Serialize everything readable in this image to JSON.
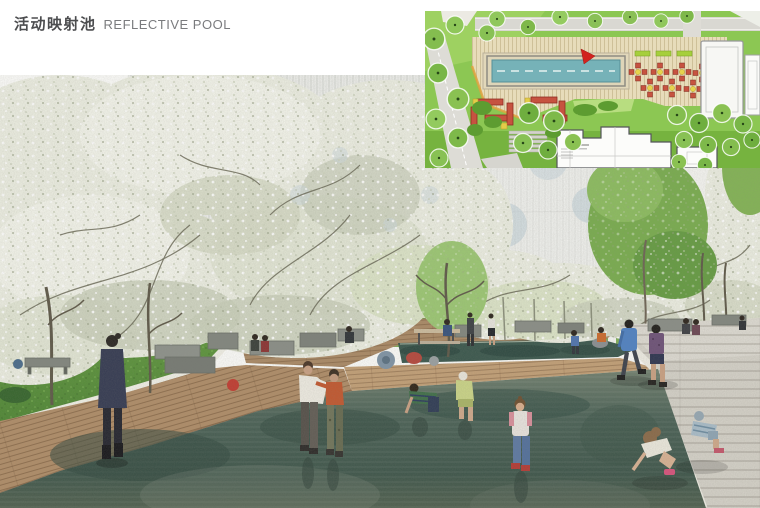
{
  "page": {
    "background": "#ffffff",
    "title_zh": "活动映射池",
    "title_en": "REFLECTIVE POOL"
  },
  "rendering": {
    "label": "reflective-pool-perspective-rendering",
    "scene": "Perspective view of a shallow reflective pool plaza under white blossoming trees; children play in the water, adults rest on stone benches along a timber boardwalk, a stone path runs along the right edge",
    "elements": [
      "white-blossom-canopy",
      "building-facade",
      "green-tree",
      "white-colonnade",
      "lawn",
      "timber-boardwalk",
      "timber-deck",
      "stone-benches",
      "picnic-table",
      "bean-bags",
      "reflective-water",
      "stone-pavement",
      "tree-trunks"
    ],
    "figures": [
      {
        "name": "woman-dark-coat",
        "detail": "walking on boardwalk in navy coat"
      },
      {
        "name": "child-white-top",
        "detail": "playing in water, holding friend"
      },
      {
        "name": "child-orange-top",
        "detail": "playing in water, camo pants"
      },
      {
        "name": "boy-striped-tee-crouching",
        "detail": "green striped tee, wading"
      },
      {
        "name": "child-lime-outfit-crouching",
        "detail": "white cap, lime outfit"
      },
      {
        "name": "toddler-pink-raglan",
        "detail": "pink raglan tee, jeans, red shoes"
      },
      {
        "name": "boy-blue-hoodie",
        "detail": "walking on stone path"
      },
      {
        "name": "boy-plum-tee",
        "detail": "walking on stone path"
      },
      {
        "name": "girl-white-top-crouching",
        "detail": "reaching into water at pool edge"
      },
      {
        "name": "child-striped-romper-crouching",
        "detail": "blue striped, at pool edge"
      },
      {
        "name": "people-on-benches",
        "detail": "seated background figures"
      }
    ],
    "colors": {
      "water_dark": "#3e5a50",
      "water_light": "#6f7f6e",
      "deck_wood": "#b2906c",
      "lawn_green": "#5f9a3f",
      "blossom_white": "#eef0e6",
      "foliage_green": "#79ad4e",
      "stone_gray": "#d3d0c7",
      "bench_gray": "#7e827b"
    }
  },
  "site_plan": {
    "label": "reflective-pool-site-plan",
    "elements": [
      "lap-pool",
      "lane-line",
      "timber-deck",
      "north-marker",
      "dining-table-sets",
      "hedge-planters",
      "sun-loungers",
      "terrace-steps",
      "building-footprint",
      "tree-canopies",
      "access-road",
      "canopy-structure"
    ],
    "counts": {
      "dining_table_sets": 7,
      "sun_loungers": 7
    },
    "colors": {
      "pool_blue": "#76b2b8",
      "deck_tan": "#e7dcba",
      "grass_green": "#82c14b",
      "furniture_red": "#c65340",
      "accent_yellow": "#e3cc49",
      "marker_red": "#d2231f",
      "road_gray": "#dddcd6",
      "building_white": "#fafaf8"
    }
  }
}
